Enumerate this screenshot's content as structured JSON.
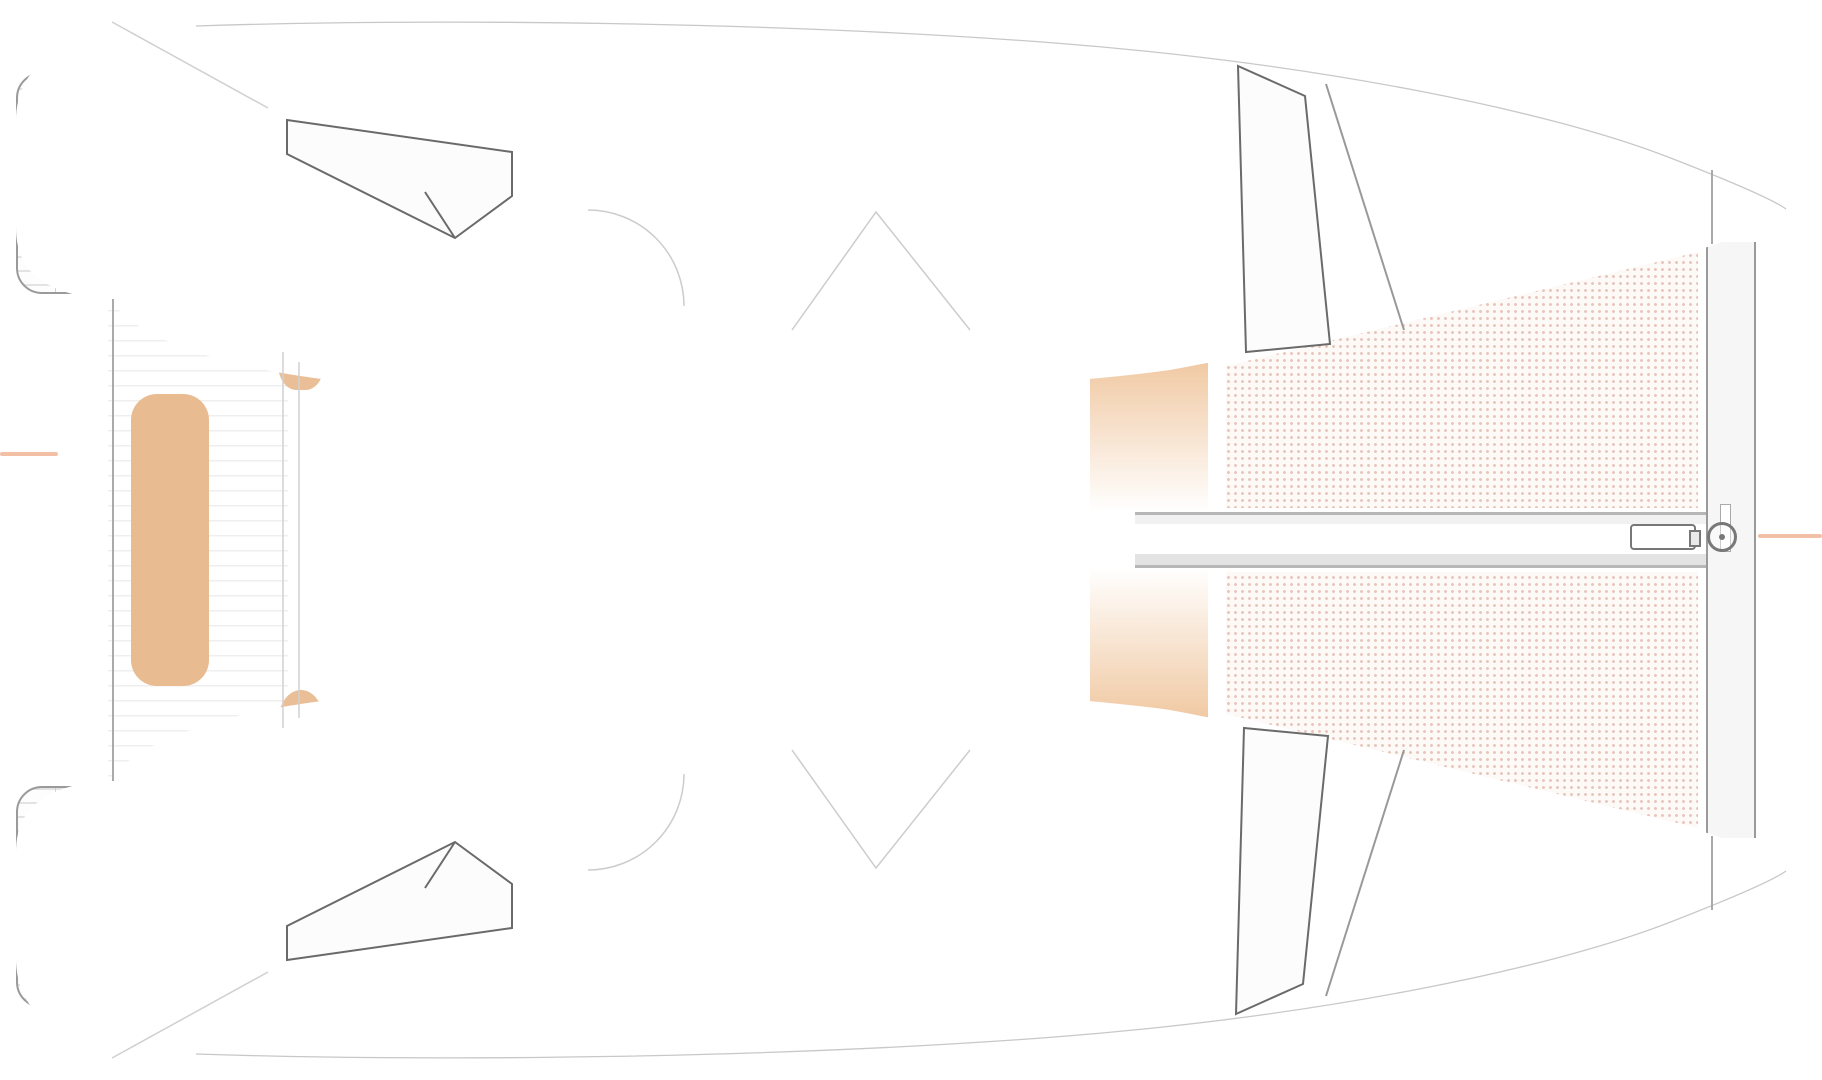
{
  "floorplan": {
    "type": "catamaran-yacht-floorplan-top-view",
    "canvas": {
      "width": 1822,
      "height": 1080
    },
    "palette": {
      "outline": "#9a9a9a",
      "mattress": "#f3c9a1",
      "bench": "#e9bb90",
      "trampbg": "#fdf9f7",
      "salmon": "#f3c0a6",
      "book1": "#8d4a38",
      "book2": "#5c5c66",
      "book3": "#b06a3c",
      "duvet": "#fcfcfc",
      "wall": "#949494"
    },
    "items": [
      {
        "n": "cockpit-deck-lines",
        "c": "lane",
        "x": 108,
        "y": 70,
        "w": 180,
        "h": 940
      },
      {
        "n": "stern-platform-port",
        "c": "platform",
        "x": 16,
        "y": 72,
        "w": 92,
        "h": 222
      },
      {
        "n": "stern-platform-starboard",
        "c": "platform",
        "x": 16,
        "y": 786,
        "w": 92,
        "h": 222
      },
      {
        "n": "cockpit-table-port",
        "c": "table",
        "x": 176,
        "y": 96,
        "w": 58,
        "h": 186
      },
      {
        "n": "cockpit-table-starboard",
        "c": "table",
        "x": 176,
        "y": 798,
        "w": 58,
        "h": 184
      },
      {
        "n": "cockpit-bench-port",
        "c": "bench",
        "x": 101,
        "y": 84,
        "w": 55,
        "h": 214
      },
      {
        "n": "cockpit-bench-center",
        "c": "bench big",
        "x": 131,
        "y": 394,
        "w": 78,
        "h": 292
      },
      {
        "n": "cockpit-bench-starboard",
        "c": "bench",
        "x": 101,
        "y": 782,
        "w": 55,
        "h": 218
      },
      {
        "n": "helm-seat-port",
        "c": "seat",
        "x": 278,
        "y": 326,
        "w": 46,
        "h": 64
      },
      {
        "n": "helm-seat-starboard",
        "c": "seat",
        "x": 278,
        "y": 690,
        "w": 46,
        "h": 64
      },
      {
        "n": "floor-aft-cabin-port",
        "c": "floor",
        "x": 512,
        "y": 114,
        "w": 74,
        "h": 218
      },
      {
        "n": "floor-corridor-port-a",
        "c": "floor",
        "x": 586,
        "y": 112,
        "w": 90,
        "h": 196
      },
      {
        "n": "floor-corridor-port-b",
        "c": "floor",
        "x": 586,
        "y": 212,
        "w": 400,
        "h": 94
      },
      {
        "n": "floor-corridor-port-c",
        "c": "floor",
        "x": 986,
        "y": 112,
        "w": 100,
        "h": 194
      },
      {
        "n": "floor-aft-cabin-starboard",
        "c": "floor",
        "x": 512,
        "y": 748,
        "w": 74,
        "h": 218
      },
      {
        "n": "floor-corridor-stbd-a",
        "c": "floor",
        "x": 586,
        "y": 772,
        "w": 90,
        "h": 196
      },
      {
        "n": "floor-corridor-stbd-b",
        "c": "floor",
        "x": 586,
        "y": 774,
        "w": 400,
        "h": 94
      },
      {
        "n": "floor-corridor-stbd-c",
        "c": "floor",
        "x": 986,
        "y": 774,
        "w": 100,
        "h": 194
      },
      {
        "n": "foredeck-shade-port",
        "c": "gradband",
        "x": 1090,
        "y": 344,
        "w": 118,
        "h": 168
      },
      {
        "n": "foredeck-shade-starboard",
        "c": "gradband flip",
        "x": 1090,
        "y": 568,
        "w": 118,
        "h": 168
      },
      {
        "n": "trampoline-upper",
        "c": "tramp",
        "clip": "1226px 366px, 1698px 252px, 1698px 508px, 1226px 508px"
      },
      {
        "n": "trampoline-lower",
        "c": "tramp",
        "clip": "1226px 714px, 1698px 828px, 1698px 572px, 1226px 572px"
      },
      {
        "n": "bowsprit-beam",
        "c": "beam",
        "x": 1135,
        "y": 512,
        "w": 572,
        "h": 56
      },
      {
        "n": "forward-crossbeam",
        "c": "crossbeam",
        "x": 1706,
        "y": 242,
        "w": 50,
        "h": 596
      },
      {
        "n": "bowsprit-fitting",
        "c": "fitting",
        "x": 1630,
        "y": 524,
        "w": 66,
        "h": 26
      },
      {
        "n": "forestay-ring",
        "c": "ring",
        "x": 1707,
        "y": 522,
        "w": 30,
        "h": 30
      },
      {
        "n": "waterline-mark-left",
        "c": "salmonline",
        "x": 0,
        "y": 452,
        "w": 58,
        "h": 4
      },
      {
        "n": "forestay-line-right",
        "c": "salmonline",
        "x": 1758,
        "y": 534,
        "w": 64,
        "h": 4
      },
      {
        "n": "bed-aft-port",
        "c": "bed",
        "x": 286,
        "y": 112,
        "w": 226,
        "h": 244
      },
      {
        "n": "bed-forward-port",
        "c": "bed",
        "x": 1085,
        "y": 62,
        "w": 174,
        "h": 290
      },
      {
        "n": "bed-aft-starboard",
        "c": "bed",
        "x": 286,
        "y": 724,
        "w": 226,
        "h": 244
      },
      {
        "n": "bed-forward-starboard",
        "c": "bed",
        "x": 1077,
        "y": 742,
        "w": 170,
        "h": 284
      },
      {
        "n": "shelf-aft-port-1",
        "c": "shelf",
        "x": 292,
        "y": 42,
        "w": 97,
        "h": 72
      },
      {
        "n": "shelf-aft-port-2",
        "c": "shelf",
        "x": 396,
        "y": 54,
        "w": 92,
        "h": 62
      },
      {
        "n": "shelf-aft-stbd-1",
        "c": "shelf",
        "x": 292,
        "y": 966,
        "w": 97,
        "h": 72
      },
      {
        "n": "shelf-aft-stbd-2",
        "c": "shelf",
        "x": 396,
        "y": 964,
        "w": 92,
        "h": 62
      },
      {
        "n": "wardrobe-fwd-port-1",
        "c": "wardrobe",
        "x": 1334,
        "y": 100,
        "w": 58,
        "h": 100
      },
      {
        "n": "wardrobe-fwd-port-2",
        "c": "wardrobe",
        "x": 1328,
        "y": 212,
        "w": 58,
        "h": 100
      },
      {
        "n": "wardrobe-fwd-stbd-1",
        "c": "wardrobe",
        "x": 1300,
        "y": 768,
        "w": 57,
        "h": 102
      },
      {
        "n": "wardrobe-fwd-stbd-2",
        "c": "wardrobe",
        "x": 1310,
        "y": 880,
        "w": 57,
        "h": 106
      },
      {
        "n": "locker-books-port-1",
        "c": "locker-books",
        "x": 584,
        "y": 52,
        "w": 88,
        "h": 58
      },
      {
        "n": "galley-counter-port",
        "c": "box",
        "x": 676,
        "y": 32,
        "w": 92,
        "h": 78
      },
      {
        "n": "toilet-port",
        "c": "toilet",
        "x": 788,
        "y": 50,
        "w": 82,
        "h": 68
      },
      {
        "n": "washroom-port",
        "c": "sinkroom",
        "x": 676,
        "y": 110,
        "w": 102,
        "h": 100
      },
      {
        "n": "sink-port",
        "c": "sink",
        "x": 690,
        "y": 128,
        "w": 80,
        "h": 62
      },
      {
        "n": "shower-port",
        "c": "shower",
        "x": 876,
        "y": 80,
        "w": 110,
        "h": 130
      },
      {
        "n": "locker-books-port-2",
        "c": "locker-books",
        "x": 988,
        "y": 54,
        "w": 97,
        "h": 57
      },
      {
        "n": "locker-books-port-3",
        "c": "locker-books",
        "x": 588,
        "y": 306,
        "w": 85,
        "h": 74
      },
      {
        "n": "companionway-stairs-port",
        "c": "stairs down",
        "x": 684,
        "y": 262,
        "w": 92,
        "h": 120
      },
      {
        "n": "locker-dishes-port-1",
        "c": "locker-dishes",
        "x": 788,
        "y": 306,
        "w": 94,
        "h": 74
      },
      {
        "n": "locker-books-port-4",
        "c": "locker-books",
        "x": 896,
        "y": 304,
        "w": 88,
        "h": 76
      },
      {
        "n": "locker-dishes-port-2",
        "c": "locker-dishes",
        "x": 990,
        "y": 300,
        "w": 76,
        "h": 52
      },
      {
        "n": "locker-books-stbd-1",
        "c": "locker-books",
        "x": 590,
        "y": 716,
        "w": 86,
        "h": 62
      },
      {
        "n": "locker-dishes-stbd-1",
        "c": "locker-dishes",
        "x": 684,
        "y": 704,
        "w": 96,
        "h": 78
      },
      {
        "n": "companionway-stairs-stbd",
        "c": "stairs up",
        "x": 778,
        "y": 702,
        "w": 96,
        "h": 120
      },
      {
        "n": "locker-dishes-stbd-2",
        "c": "locker-dishes",
        "x": 882,
        "y": 728,
        "w": 30,
        "h": 50
      },
      {
        "n": "locker-books-stbd-2",
        "c": "locker-books",
        "x": 914,
        "y": 728,
        "w": 72,
        "h": 52
      },
      {
        "n": "locker-dishes-stbd-3",
        "c": "locker-dishes",
        "x": 992,
        "y": 734,
        "w": 72,
        "h": 50
      },
      {
        "n": "shower-starboard",
        "c": "shower",
        "x": 682,
        "y": 874,
        "w": 104,
        "h": 132
      },
      {
        "n": "shower-entry-stbd",
        "c": "box",
        "x": 682,
        "y": 1008,
        "w": 104,
        "h": 38
      },
      {
        "n": "toilet-starboard",
        "c": "toilet",
        "x": 790,
        "y": 960,
        "w": 82,
        "h": 68,
        "r": 180
      },
      {
        "n": "washroom-starboard",
        "c": "sinkroom",
        "x": 876,
        "y": 872,
        "w": 104,
        "h": 100
      },
      {
        "n": "sink-starboard",
        "c": "sink",
        "x": 896,
        "y": 892,
        "w": 80,
        "h": 62
      },
      {
        "n": "counter-stbd",
        "c": "box",
        "x": 886,
        "y": 1008,
        "w": 104,
        "h": 38
      },
      {
        "n": "locker-books-stbd-3",
        "c": "locker-books",
        "x": 584,
        "y": 984,
        "w": 98,
        "h": 50
      },
      {
        "n": "locker-books-stbd-4",
        "c": "locker-books",
        "x": 998,
        "y": 982,
        "w": 62,
        "h": 48
      },
      {
        "n": "pillow",
        "c": "pillow",
        "x": 318,
        "y": 208,
        "w": 62,
        "h": 56,
        "r": -14
      },
      {
        "n": "pillow",
        "c": "pillow",
        "x": 356,
        "y": 248,
        "w": 66,
        "h": 58,
        "r": 26
      },
      {
        "n": "pillow",
        "c": "pillow",
        "x": 1120,
        "y": 124,
        "w": 64,
        "h": 56,
        "r": -18
      },
      {
        "n": "pillow",
        "c": "pillow",
        "x": 1156,
        "y": 180,
        "w": 68,
        "h": 60,
        "r": 24
      },
      {
        "n": "pillow",
        "c": "pillow",
        "x": 318,
        "y": 816,
        "w": 62,
        "h": 56,
        "r": 14
      },
      {
        "n": "pillow",
        "c": "pillow",
        "x": 356,
        "y": 766,
        "w": 66,
        "h": 58,
        "r": -26
      },
      {
        "n": "pillow",
        "c": "pillow",
        "x": 1128,
        "y": 850,
        "w": 62,
        "h": 56,
        "r": 40
      },
      {
        "n": "pillow",
        "c": "pillow",
        "x": 1106,
        "y": 902,
        "w": 62,
        "h": 54,
        "r": 6
      }
    ]
  }
}
